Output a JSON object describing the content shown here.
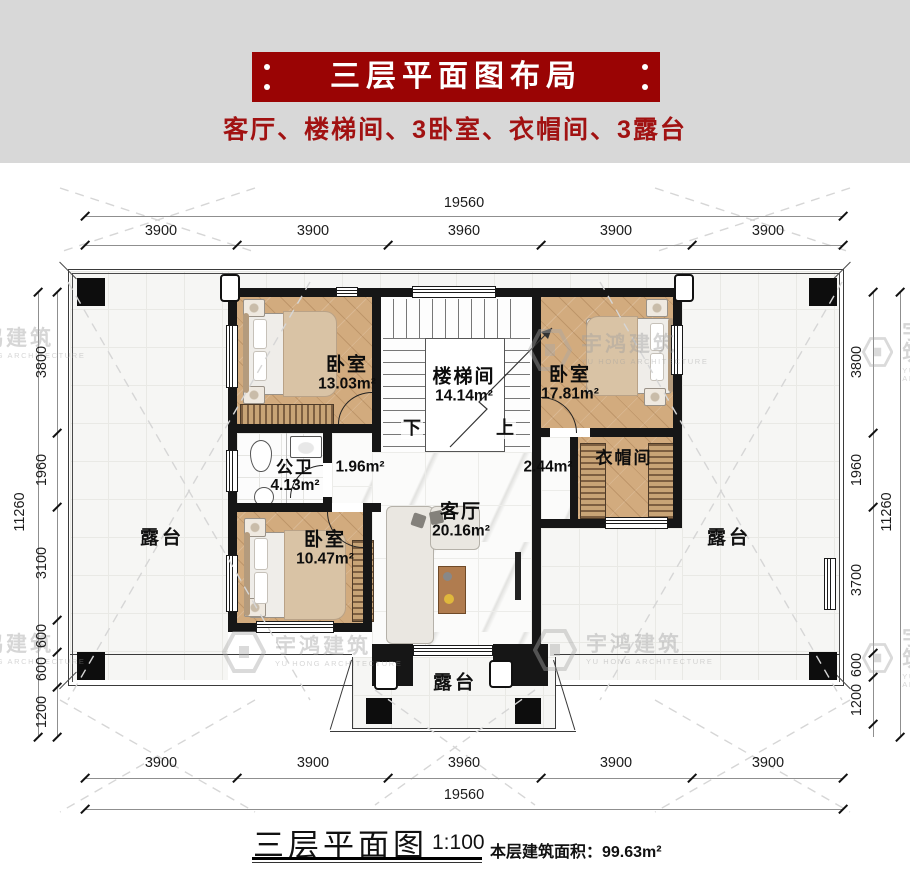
{
  "header": {
    "title": "三层平面图布局",
    "subtitle": "客厅、楼梯间、3卧室、衣帽间、3露台"
  },
  "colors": {
    "banner_red": "#9a0404",
    "subtitle_red": "#a11212",
    "wall_black": "#161616",
    "wood_floor": "#d2ab7e",
    "watermark_gray": "#9e9e9e"
  },
  "dims": {
    "top": {
      "total": "19560",
      "segments": [
        "3900",
        "3900",
        "3960",
        "3900",
        "3900"
      ]
    },
    "bottom": {
      "total": "19560",
      "segments": [
        "3900",
        "3900",
        "3960",
        "3900",
        "3900"
      ]
    },
    "left": {
      "total": "11260",
      "segments": [
        "3800",
        "1960",
        "3100",
        "600",
        "600",
        "1200"
      ]
    },
    "right": {
      "total": "11260",
      "segments": [
        "3800",
        "1960",
        "3700",
        "600",
        "1200"
      ]
    }
  },
  "rooms": {
    "bedroom_tl": {
      "name": "卧室",
      "area": "13.03m²"
    },
    "stairwell": {
      "name": "楼梯间",
      "area": "14.14m²",
      "down": "下",
      "up": "上"
    },
    "bedroom_tr": {
      "name": "卧室",
      "area": "17.81m²"
    },
    "bathroom": {
      "name": "公卫",
      "area": "4.13m²"
    },
    "hall_left": {
      "area": "1.96m²"
    },
    "hall_right": {
      "area": "2.44m²"
    },
    "cloakroom": {
      "name": "衣帽间"
    },
    "living_room": {
      "name": "客厅",
      "area": "20.16m²"
    },
    "bedroom_bl": {
      "name": "卧室",
      "area": "10.47m²"
    },
    "terrace_left": {
      "name": "露台"
    },
    "terrace_right": {
      "name": "露台"
    },
    "terrace_bottom": {
      "name": "露台"
    }
  },
  "footer": {
    "title": "三层平面图",
    "scale": "1:100",
    "area_text": "本层建筑面积：99.63m²"
  },
  "watermark": {
    "text": "宇鸿建筑",
    "subtext": "YU HONG ARCHITECTURE"
  }
}
